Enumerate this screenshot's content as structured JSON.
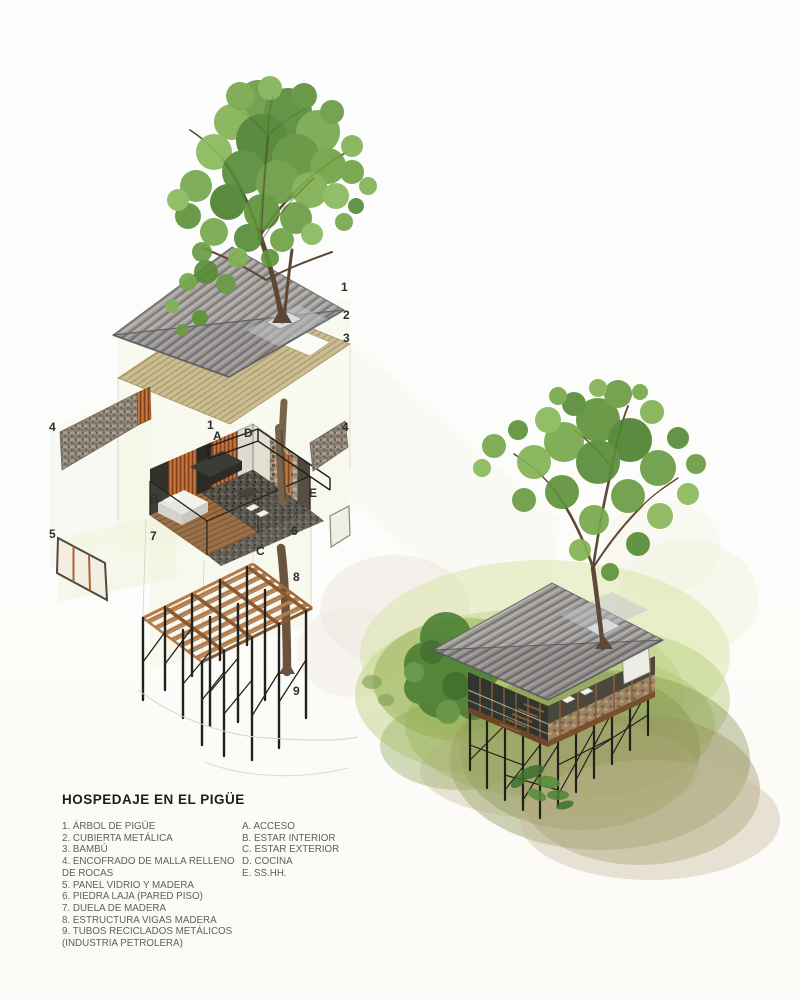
{
  "title": "HOSPEDAJE EN EL PIGÜE",
  "legend": {
    "materials": [
      "1. ÁRBOL DE PIGÜE",
      "2. CUBIERTA METÁLICA",
      "3. BAMBÚ",
      "4. ENCOFRADO DE MALLA RELLENO DE ROCAS",
      "5. PANEL VIDRIO Y MADERA",
      "6. PIEDRA LAJA (PARED PISO)",
      "7. DUELA DE MADERA",
      "8. ESTRUCTURA VIGAS MADERA",
      "9. TUBOS RECICLADOS METÁLICOS (INDUSTRIA PETROLERA)"
    ],
    "spaces": [
      "A. ACCESO",
      "B. ESTAR INTERIOR",
      "C. ESTAR EXTERIOR",
      "D. COCINA",
      "E. SS.HH."
    ]
  },
  "callouts": {
    "roof_tree": "1",
    "roof_metal": "2",
    "roof_bamboo": "3",
    "module_tree": "1",
    "access": "A",
    "kitchen": "D",
    "gabion_left": "4",
    "gabion_right": "4",
    "interior": "B",
    "bath": "E",
    "glass_panel": "5",
    "wood_floor": "7",
    "stone": "6",
    "exterior": "C",
    "beams": "8",
    "tubes": "9"
  },
  "colors": {
    "canopy_green": "#5f9339",
    "roof_gray": "#a3a09d",
    "wood_orange": "#b5622d",
    "beam_wood": "#b57c4a",
    "steel_black": "#21211e",
    "terrain_green": "#a9c067",
    "label_ink": "#2e2e2c",
    "legend_text": "#5f5f5f"
  }
}
